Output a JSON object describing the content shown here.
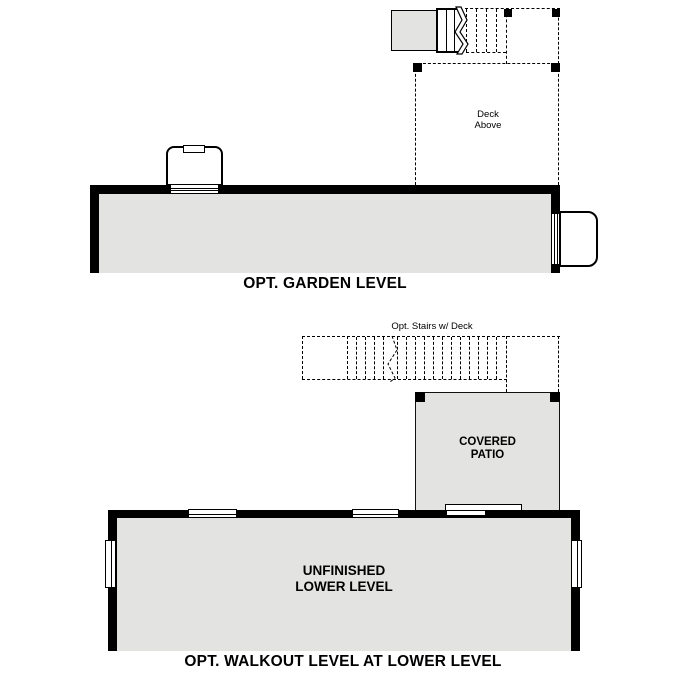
{
  "colors": {
    "background": "#ffffff",
    "wall": "#000000",
    "room_fill": "#e3e3e2",
    "text": "#000000"
  },
  "garden_level": {
    "title": "OPT. GARDEN LEVEL",
    "deck_label": {
      "line1": "Deck",
      "line2": "Above"
    }
  },
  "walkout_level": {
    "title": "OPT. WALKOUT LEVEL AT LOWER LEVEL",
    "stairs_label": "Opt. Stairs w/ Deck",
    "patio_label": {
      "line1": "COVERED",
      "line2": "PATIO"
    },
    "room_label": {
      "line1": "UNFINISHED",
      "line2": "LOWER LEVEL"
    }
  }
}
